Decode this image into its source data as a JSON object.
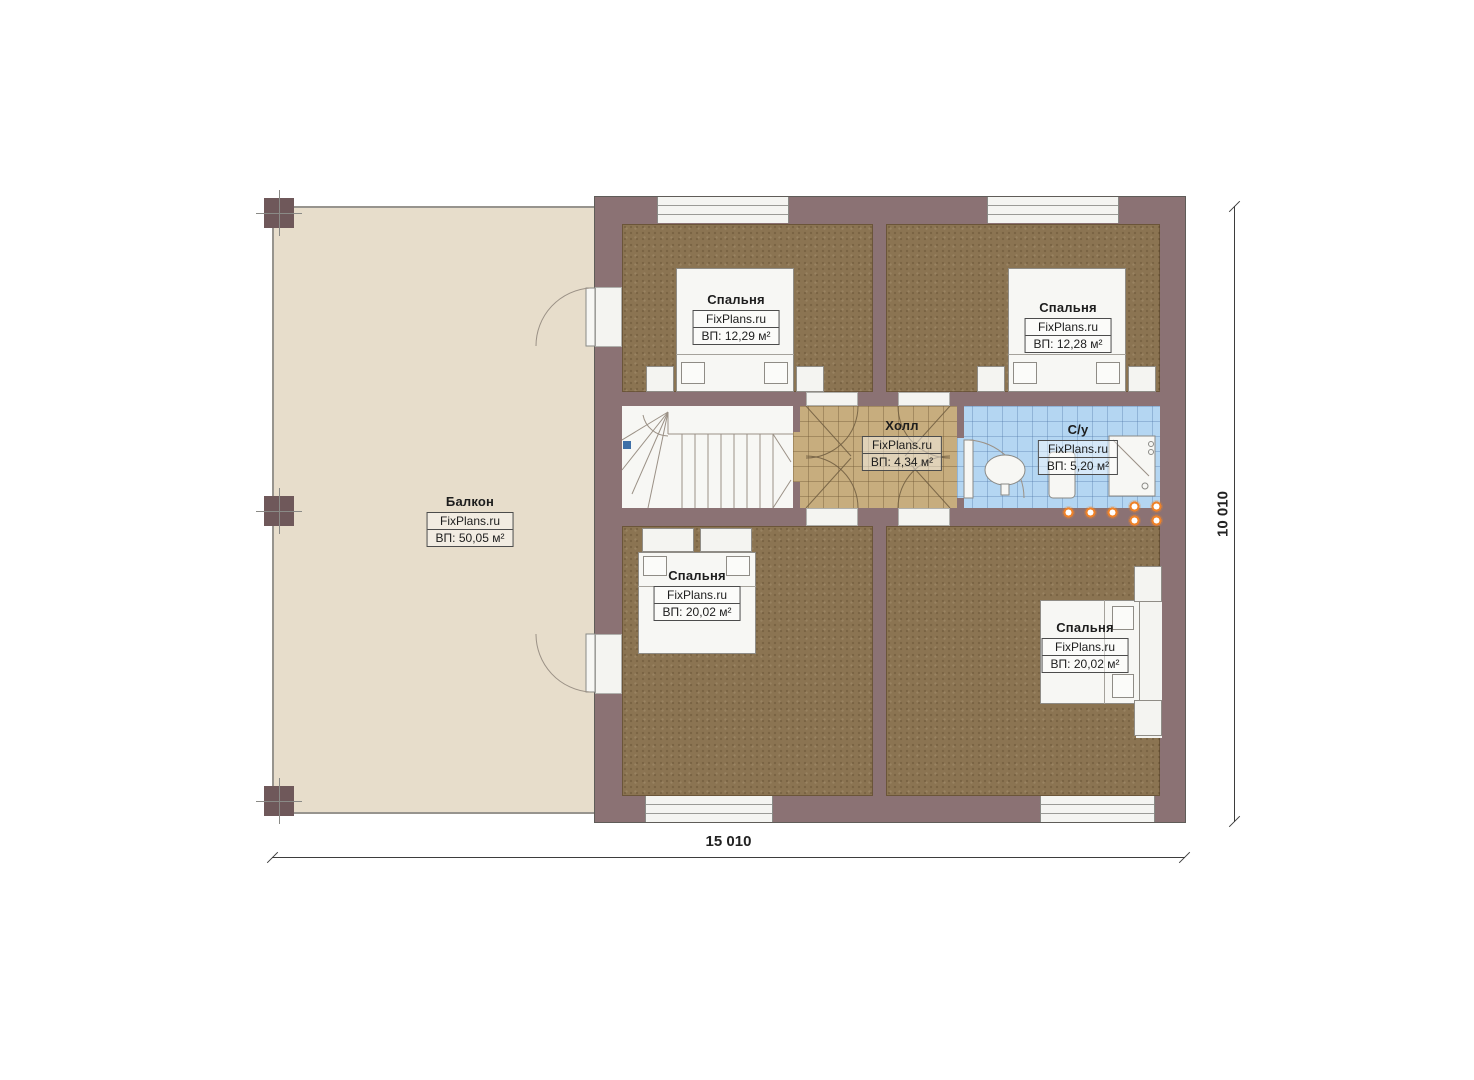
{
  "plan": {
    "brand": "FixPlans.ru",
    "rooms": {
      "balcony": {
        "name": "Балкон",
        "area": "ВП: 50,05 м²"
      },
      "bedroom_tl": {
        "name": "Спальня",
        "area": "ВП: 12,29 м²"
      },
      "bedroom_tr": {
        "name": "Спальня",
        "area": "ВП: 12,28 м²"
      },
      "hall": {
        "name": "Холл",
        "area": "ВП: 4,34 м²"
      },
      "bathroom": {
        "name": "С/у",
        "area": "ВП: 5,20 м²"
      },
      "bedroom_bl": {
        "name": "Спальня",
        "area": "ВП: 20,02 м²"
      },
      "bedroom_br": {
        "name": "Спальня",
        "area": "ВП: 20,02 м²"
      }
    },
    "dimensions": {
      "width": "15 010",
      "height": "10 010"
    },
    "colors": {
      "wall": "#8b7274",
      "bedroom_floor": "#8b7452",
      "hall_floor": "#c7ad7e",
      "bathroom_floor": "#b4d6f2",
      "balcony_floor": "#e7ddcb",
      "spotlight": "#ef8228"
    }
  }
}
